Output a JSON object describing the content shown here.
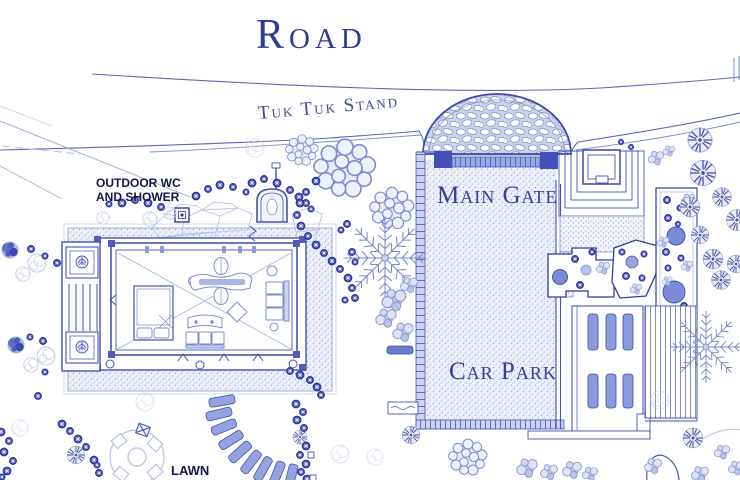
{
  "page": {
    "title": "Resort site plan blueprint drawing"
  },
  "labels": {
    "road": "Road",
    "tuk_tuk_stand": "Tuk Tuk Stand",
    "main_gate": "Main Gate",
    "car_park": "Car Park",
    "outdoor_wc_line1": "OUTDOOR WC",
    "outdoor_wc_line2": "AND SHOWER",
    "lawn": "LAWN"
  },
  "palette": {
    "ink": "#4353b4",
    "ink_dark": "#2e3a94",
    "serif_label_color": "#333e9e",
    "sans_label_color": "#14154d",
    "solid_fill": "#8b99dd",
    "texture_light": "#edeff9",
    "paper": "#ffffff"
  }
}
